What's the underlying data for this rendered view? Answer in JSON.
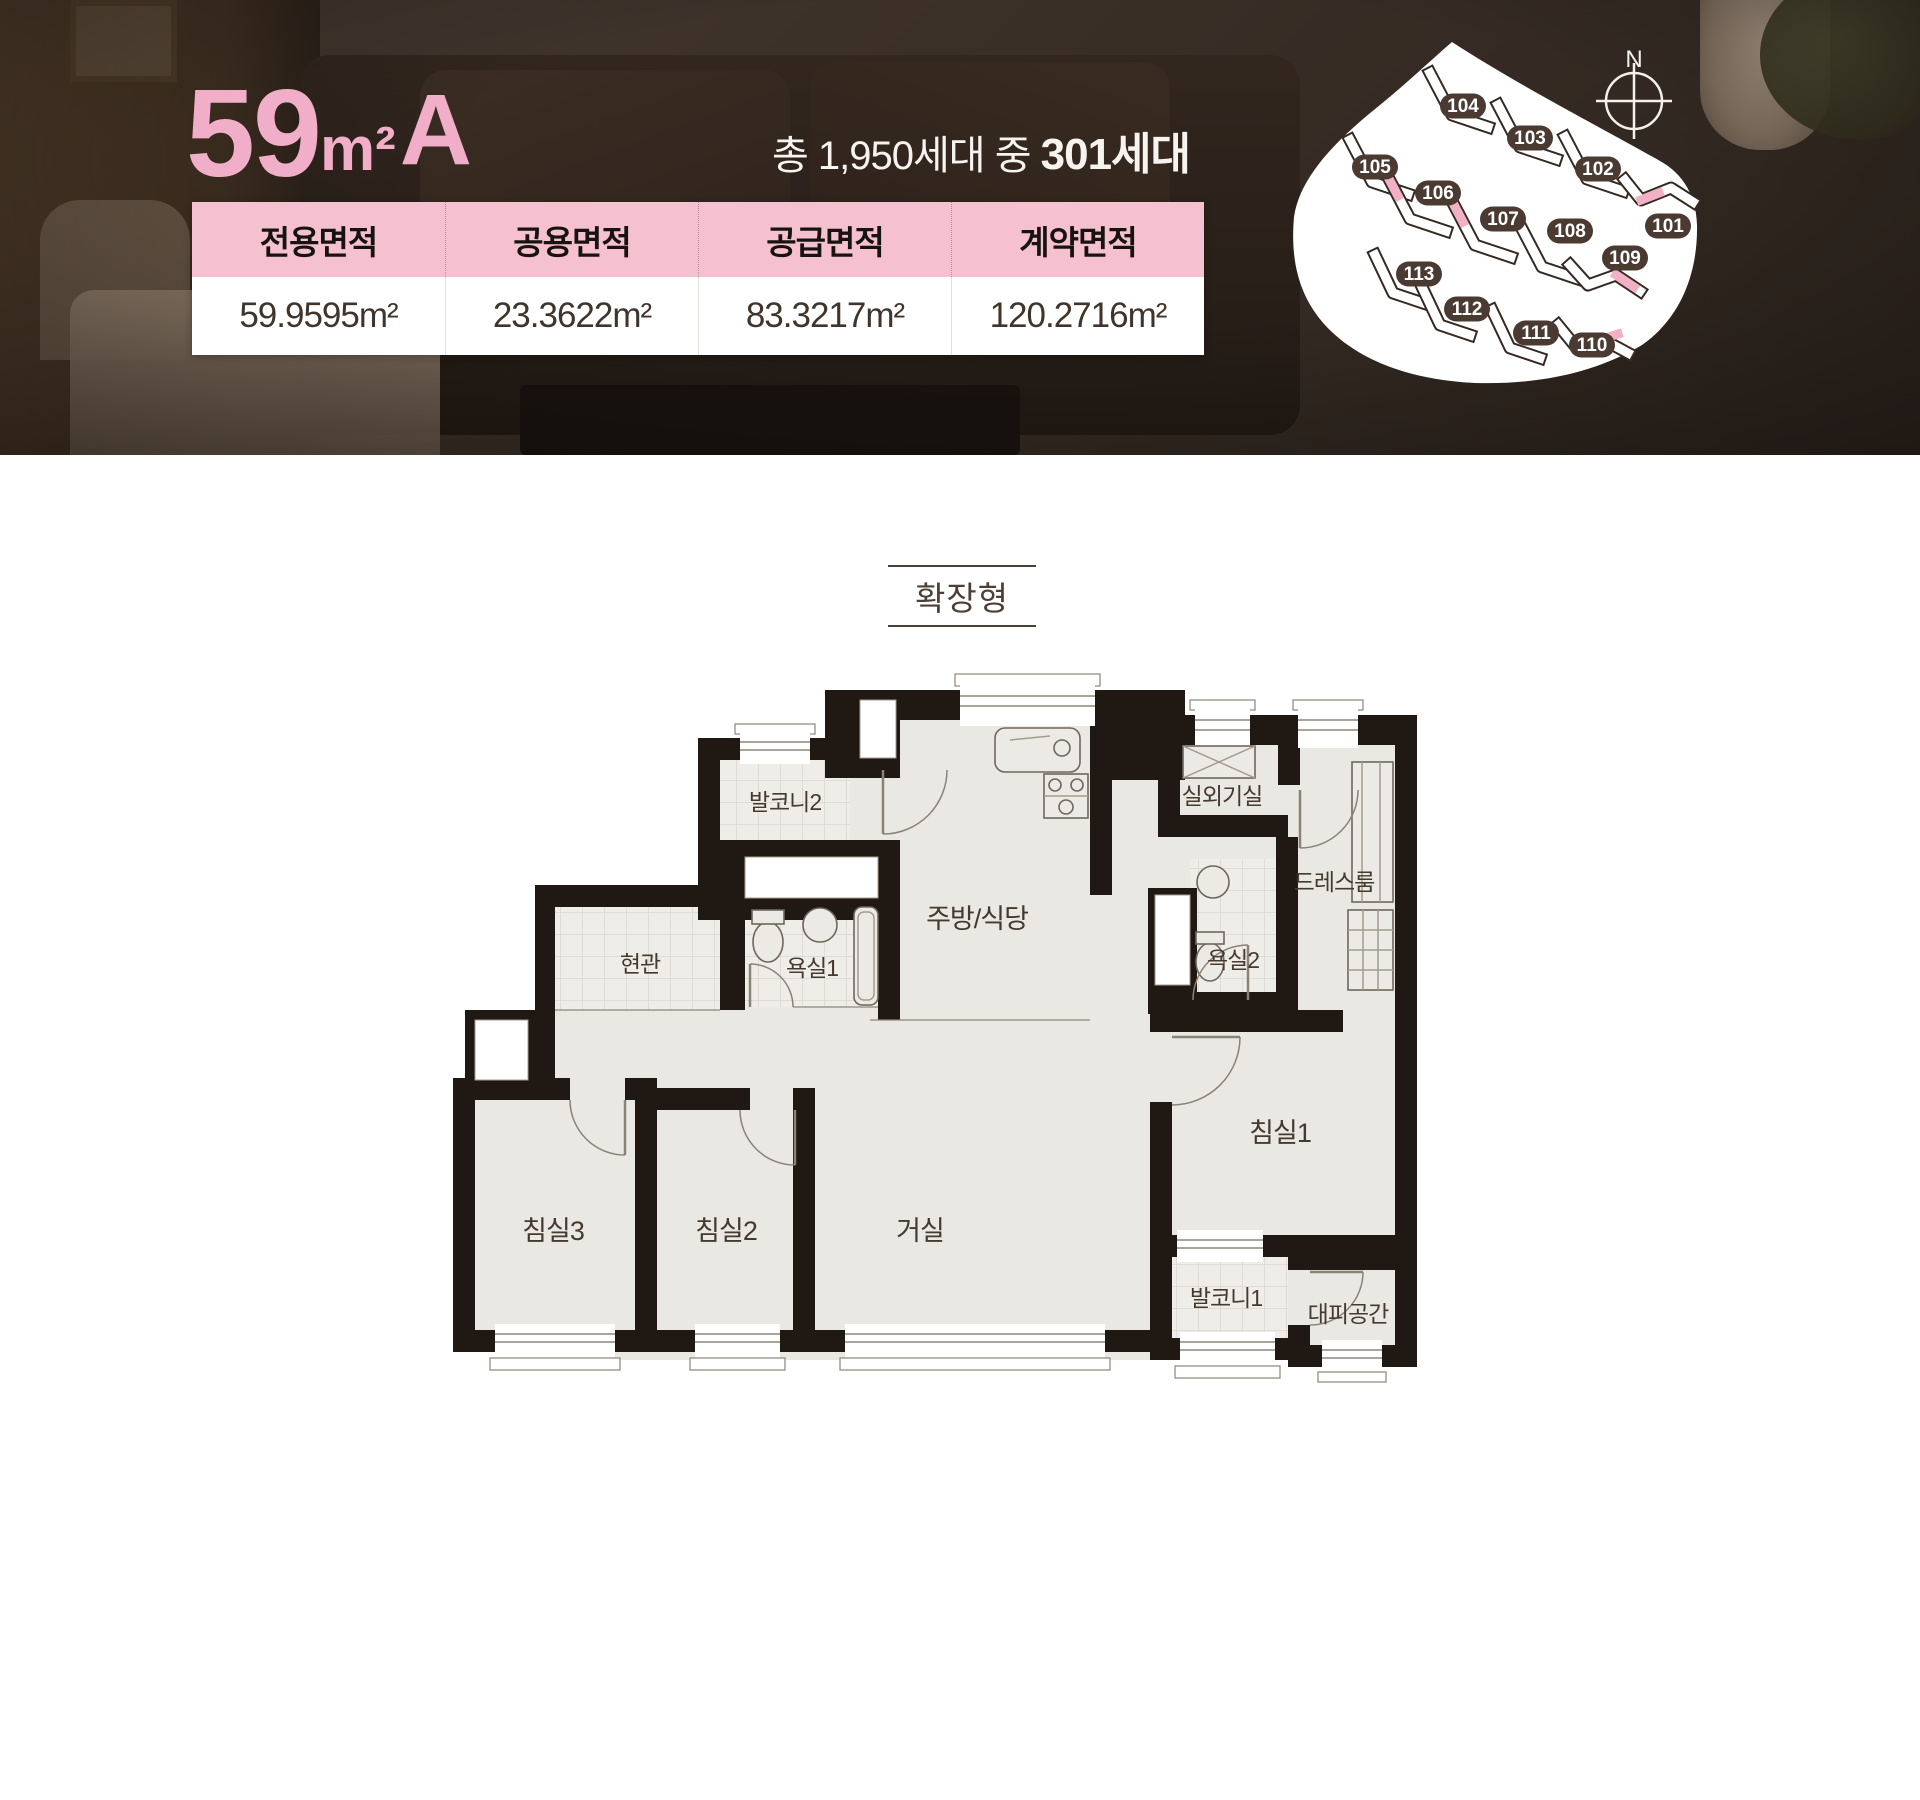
{
  "header": {
    "title": {
      "size": "59",
      "unit": "m²",
      "type": "A"
    },
    "units_line": {
      "prefix": "총 1,950세대 중 ",
      "highlight": "301세대"
    },
    "table": {
      "columns": [
        {
          "label": "전용면적",
          "value": "59.9595m²"
        },
        {
          "label": "공용면적",
          "value": "23.3622m²"
        },
        {
          "label": "공급면적",
          "value": "83.3217m²"
        },
        {
          "label": "계약면적",
          "value": "120.2716m²"
        }
      ]
    },
    "site_map": {
      "north_label": "N",
      "buildings": [
        {
          "id": "101"
        },
        {
          "id": "102"
        },
        {
          "id": "103"
        },
        {
          "id": "104"
        },
        {
          "id": "105"
        },
        {
          "id": "106"
        },
        {
          "id": "107"
        },
        {
          "id": "108"
        },
        {
          "id": "109"
        },
        {
          "id": "110"
        },
        {
          "id": "111"
        },
        {
          "id": "112"
        },
        {
          "id": "113"
        }
      ]
    }
  },
  "plan": {
    "tag": "확장형",
    "rooms": [
      {
        "name": "발코니2"
      },
      {
        "name": "주방/식당"
      },
      {
        "name": "실외기실"
      },
      {
        "name": "드레스룸"
      },
      {
        "name": "욕실2"
      },
      {
        "name": "현관"
      },
      {
        "name": "욕실1"
      },
      {
        "name": "침실3"
      },
      {
        "name": "침실2"
      },
      {
        "name": "거실"
      },
      {
        "name": "침실1"
      },
      {
        "name": "발코니1"
      },
      {
        "name": "대피공간"
      }
    ]
  },
  "colors": {
    "accent_pink": "#f0aec8",
    "table_header_pink": "#f5c1d1",
    "wall": "#201812",
    "room_fill": "#eae8e3",
    "badge": "#4a3a32"
  }
}
